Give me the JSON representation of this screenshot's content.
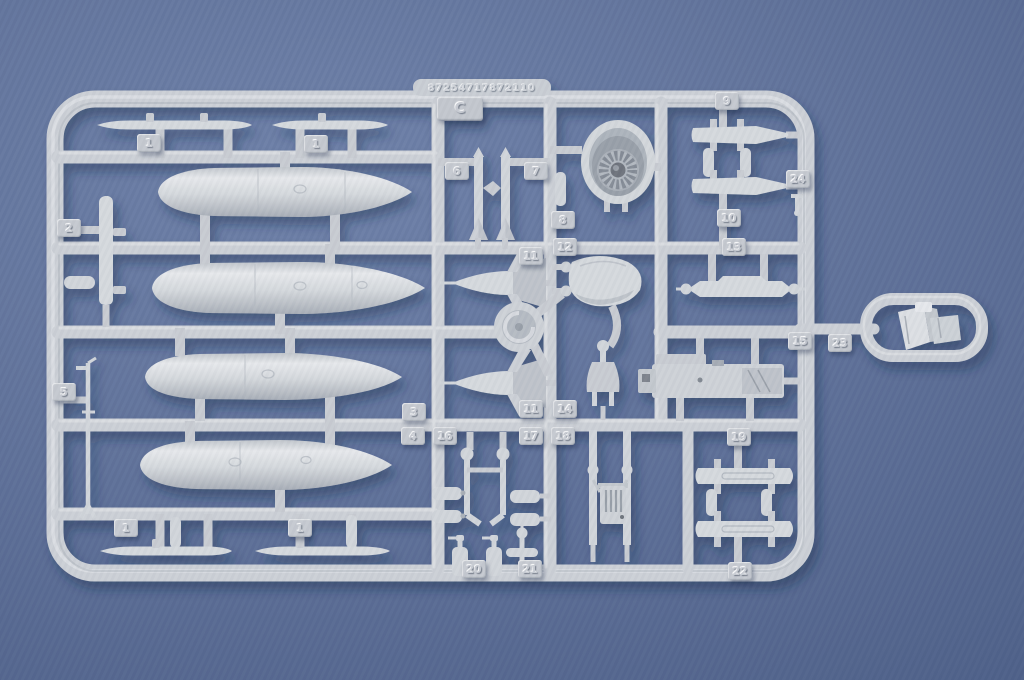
{
  "scene": {
    "type": "photograph",
    "subject": "injection-molded plastic model kit sprue (runner) on blue backdrop",
    "background_color": "#5d6f97",
    "plastic_color": "#ced2d7",
    "shadow_color": "#22305a"
  },
  "sprue": {
    "runner_letter": "C",
    "mold_code": "87254717872110",
    "parts_visible": [
      "drop-tank-half x4",
      "stabilizer-blade x4",
      "engine-exhaust-nozzle",
      "missile-nose-with-fins x2",
      "swivel-disc",
      "canopy-fairing",
      "pylon-rail x4",
      "launch-rail",
      "gun-pod",
      "landing-gear-strut x2",
      "grooved-ladder-plate",
      "oxygen-bottles",
      "ejection-seat-in-loop",
      "antenna-mast",
      "fin-blade",
      "small-gear-struts"
    ],
    "part_tabs": [
      {
        "label": "1"
      },
      {
        "label": "1"
      },
      {
        "label": "2"
      },
      {
        "label": "5"
      },
      {
        "label": "6"
      },
      {
        "label": "7"
      },
      {
        "label": "8"
      },
      {
        "label": "9"
      },
      {
        "label": "24"
      },
      {
        "label": "10"
      },
      {
        "label": "12"
      },
      {
        "label": "13"
      },
      {
        "label": "11"
      },
      {
        "label": "3"
      },
      {
        "label": "11"
      },
      {
        "label": "14"
      },
      {
        "label": "19"
      },
      {
        "label": "15"
      },
      {
        "label": "23"
      },
      {
        "label": "4"
      },
      {
        "label": "16"
      },
      {
        "label": "17"
      },
      {
        "label": "18"
      },
      {
        "label": "20"
      },
      {
        "label": "21"
      },
      {
        "label": "22"
      },
      {
        "label": "1"
      },
      {
        "label": "1"
      }
    ]
  }
}
